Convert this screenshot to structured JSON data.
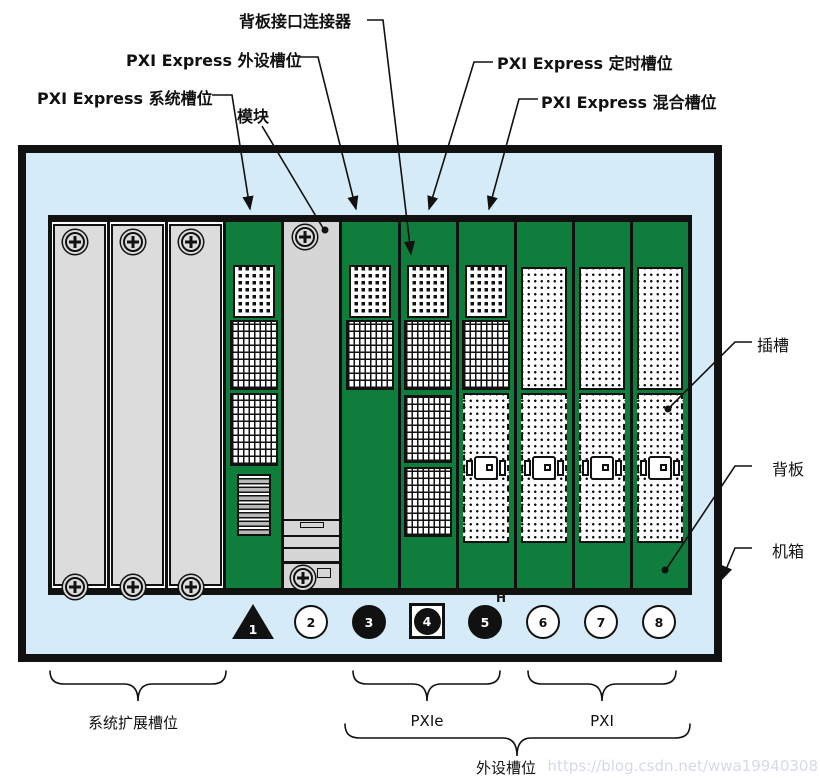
{
  "labels": {
    "backplane_connector": "背板接口连接器",
    "pxie_peripheral_slot": "PXI Express 外设槽位",
    "pxie_system_slot": "PXI Express 系统槽位",
    "module": "模块",
    "pxie_timing_slot": "PXI Express 定时槽位",
    "pxie_hybrid_slot": "PXI Express 混合槽位",
    "slot": "插槽",
    "backplane": "背板",
    "chassis": "机箱"
  },
  "slot_markers": [
    {
      "number": "1",
      "shape": "black-triangle",
      "meaning": "system-controller-slot"
    },
    {
      "number": "2",
      "shape": "white-circle",
      "meaning": "pxi-peripheral-slot"
    },
    {
      "number": "3",
      "shape": "black-circle",
      "meaning": "pxie-peripheral-slot"
    },
    {
      "number": "4",
      "shape": "black-circle-in-square",
      "meaning": "system-timing-slot"
    },
    {
      "number": "5",
      "shape": "black-circle",
      "superscript": "H",
      "meaning": "hybrid-peripheral-slot"
    },
    {
      "number": "6",
      "shape": "white-circle",
      "meaning": "pxi-peripheral-slot"
    },
    {
      "number": "7",
      "shape": "white-circle",
      "meaning": "pxi-peripheral-slot"
    },
    {
      "number": "8",
      "shape": "white-circle",
      "meaning": "pxi-peripheral-slot"
    }
  ],
  "group_labels": {
    "system_expansion": "系统扩展槽位",
    "pxie": "PXIe",
    "pxi": "PXI",
    "peripheral_slots": "外设槽位"
  },
  "watermark": "https://blog.csdn.net/wwa19940308",
  "colors": {
    "backplane_green": "#0f7d3b",
    "chassis_blue": "#d6ebf8",
    "panel_gray": "#dcdcdc",
    "line_black": "#111111",
    "watermark_gray": "#d5dae6"
  }
}
